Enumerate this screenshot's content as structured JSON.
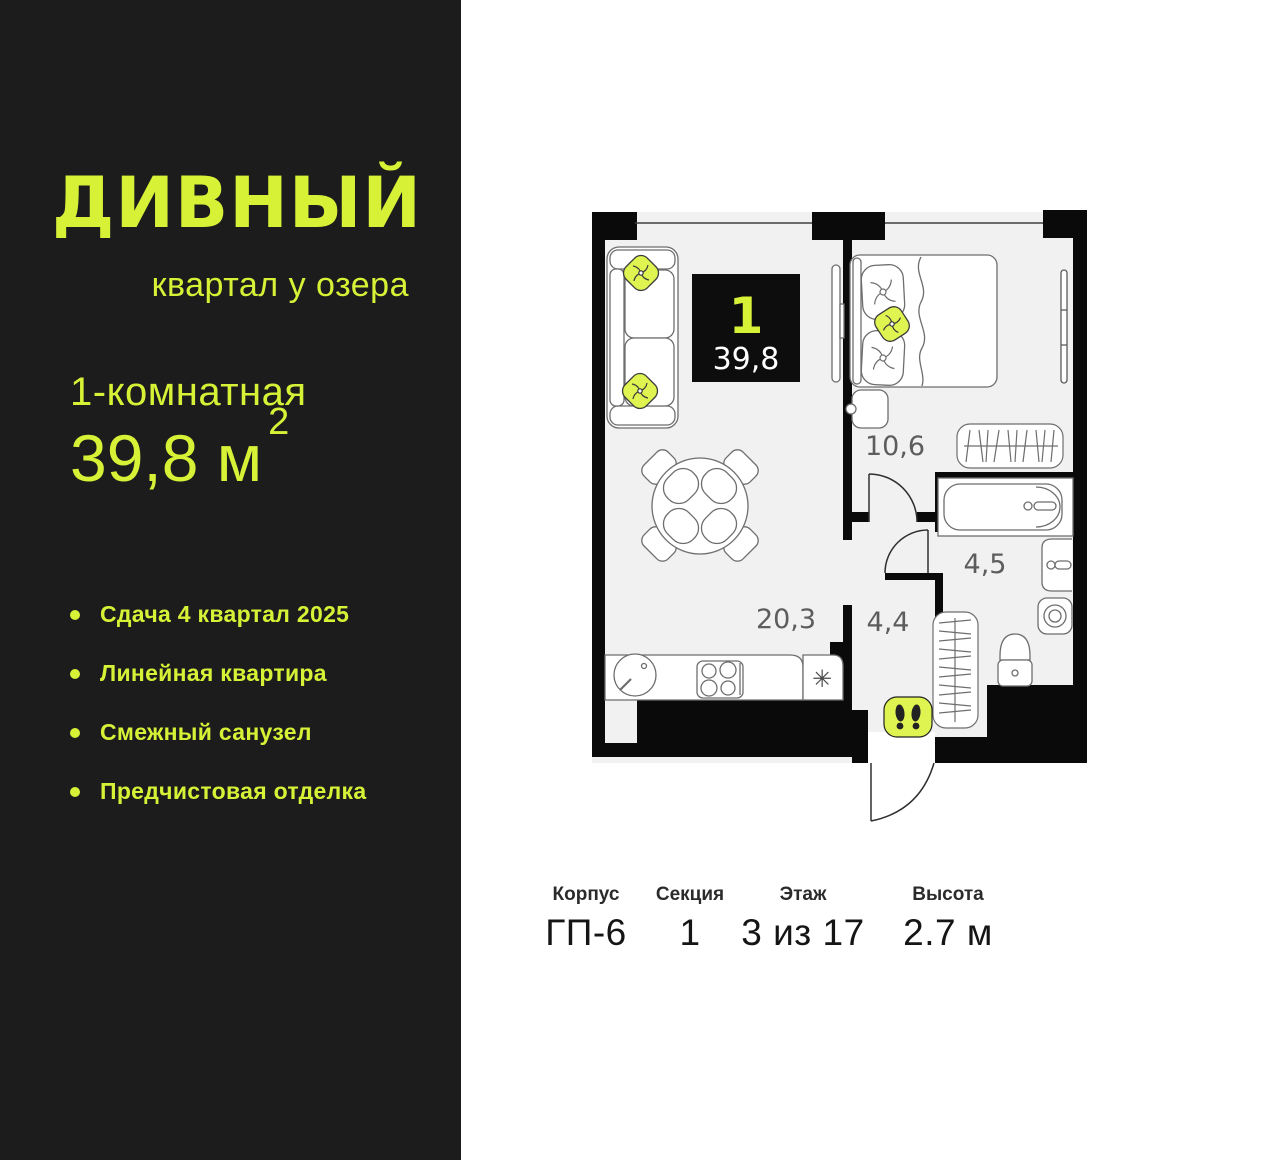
{
  "colors": {
    "accent": "#D7F236",
    "pillow_yellow": "#DFF351",
    "panel_background": "#1C1C1D",
    "plan_floor": "#F1F1F2",
    "wall_black": "#0A0A0A"
  },
  "brand": {
    "title": "ДИВНЫЙ",
    "subtitle": "квартал у озера"
  },
  "summary": {
    "rooms": "1-комнатная",
    "area_value": "39,8 м",
    "area_sup": "2"
  },
  "features": [
    "Сдача 4 квартал 2025",
    "Линейная квартира",
    "Смежный санузел",
    "Предчистовая отделка"
  ],
  "plan": {
    "badge": {
      "rooms": "1",
      "area": "39,8"
    },
    "rooms": {
      "living": "20,3",
      "bedroom": "10,6",
      "bathroom": "4,5",
      "hallway": "4,4"
    },
    "fridge_symbol": "✳"
  },
  "details": [
    {
      "label": "Корпус",
      "value": "ГП-6"
    },
    {
      "label": "Секция",
      "value": "1"
    },
    {
      "label": "Этаж",
      "value": "3 из 17"
    },
    {
      "label": "Высота",
      "value": "2.7 м"
    }
  ]
}
